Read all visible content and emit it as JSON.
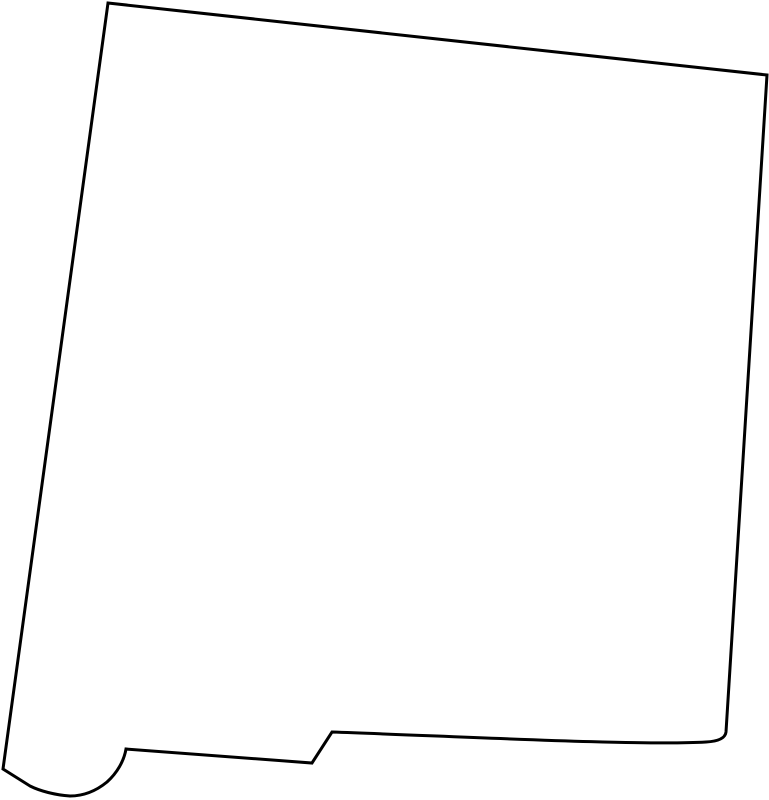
{
  "page": {
    "background_color": "#ffffff"
  },
  "map": {
    "name": "new-mexico-state-outline",
    "region": "New Mexico",
    "type": "blank-outline-map",
    "viewBox": "0 0 769 800",
    "fill_color": "#ffffff",
    "stroke_color": "#000000",
    "stroke_width": "3",
    "outline_path": "M 108,3 L 767,75 L 726,732 Q 725,741 706,742 C 640,746 450,736 332,732 L 312,763 L 126,749 C 124,761 117,773 107,782 C 96,791 84,796 70,796 C 55,795 40,791 30,786 L 3,769 Z"
  }
}
